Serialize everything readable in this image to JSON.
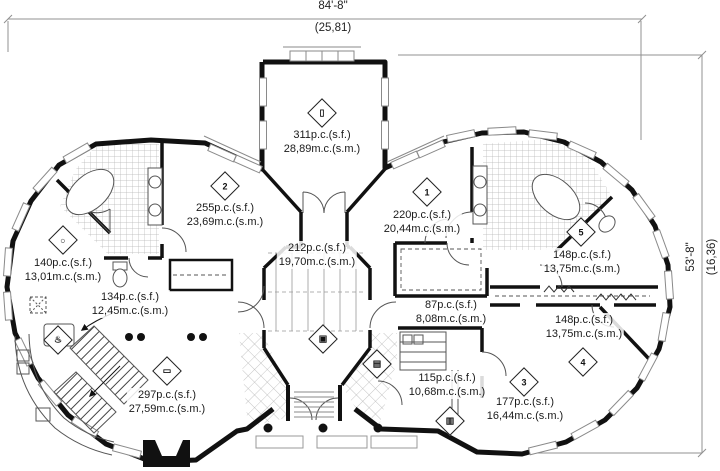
{
  "dimensions": {
    "top": {
      "imperial": "84'-8\"",
      "metric": "(25,81)"
    },
    "right": {
      "imperial": "53'-8\"",
      "metric": "(16,36)"
    }
  },
  "rooms": [
    {
      "id": "room-top-center",
      "sf": "311p.c.(s.f.)",
      "sm": "28,89m.c.(s.m.)"
    },
    {
      "id": "room-left-bedroom",
      "sf": "255p.c.(s.f.)",
      "sm": "23,69m.c.(s.m.)"
    },
    {
      "id": "room-right-bedroom",
      "sf": "220p.c.(s.f.)",
      "sm": "20,44m.c.(s.m.)"
    },
    {
      "id": "room-center-hall",
      "sf": "212p.c.(s.f.)",
      "sm": "19,70m.c.(s.m.)"
    },
    {
      "id": "room-dining",
      "sf": "140p.c.(s.f.)",
      "sm": "13,01m.c.(s.m.)"
    },
    {
      "id": "room-kitchen",
      "sf": "134p.c.(s.f.)",
      "sm": "12,45m.c.(s.m.)"
    },
    {
      "id": "room-living",
      "sf": "297p.c.(s.f.)",
      "sm": "27,59m.c.(s.m.)"
    },
    {
      "id": "room-hallway",
      "sf": "87p.c.(s.f.)",
      "sm": "8,08m.c.(s.m.)"
    },
    {
      "id": "room-right-upper",
      "sf": "148p.c.(s.f.)",
      "sm": "13,75m.c.(s.m.)"
    },
    {
      "id": "room-right-lower",
      "sf": "148p.c.(s.f.)",
      "sm": "13,75m.c.(s.m.)"
    },
    {
      "id": "room-utility",
      "sf": "115p.c.(s.f.)",
      "sm": "10,68m.c.(s.m.)"
    },
    {
      "id": "room-bottom-right",
      "sf": "177p.c.(s.f.)",
      "sm": "16,44m.c.(s.m.)"
    }
  ],
  "icons": [
    {
      "name": "bed-icon",
      "glyph": "▯"
    },
    {
      "name": "bedroom-2-badge",
      "glyph": "2"
    },
    {
      "name": "bedroom-1-badge",
      "glyph": "1"
    },
    {
      "name": "dining-table-icon",
      "glyph": "○"
    },
    {
      "name": "stove-icon",
      "glyph": "♨"
    },
    {
      "name": "sofa-icon",
      "glyph": "▭"
    },
    {
      "name": "tv-icon",
      "glyph": "▣"
    },
    {
      "name": "planter-icon",
      "glyph": "▤"
    },
    {
      "name": "room-5-badge",
      "glyph": "5"
    },
    {
      "name": "room-4-badge",
      "glyph": "4"
    },
    {
      "name": "room-3-badge",
      "glyph": "3"
    },
    {
      "name": "shelf-icon",
      "glyph": "▥"
    }
  ],
  "colors": {
    "wall": "#111111",
    "thin_line": "#8a8a8a",
    "dimension": "#909090",
    "tile": "#b5b5b5"
  }
}
